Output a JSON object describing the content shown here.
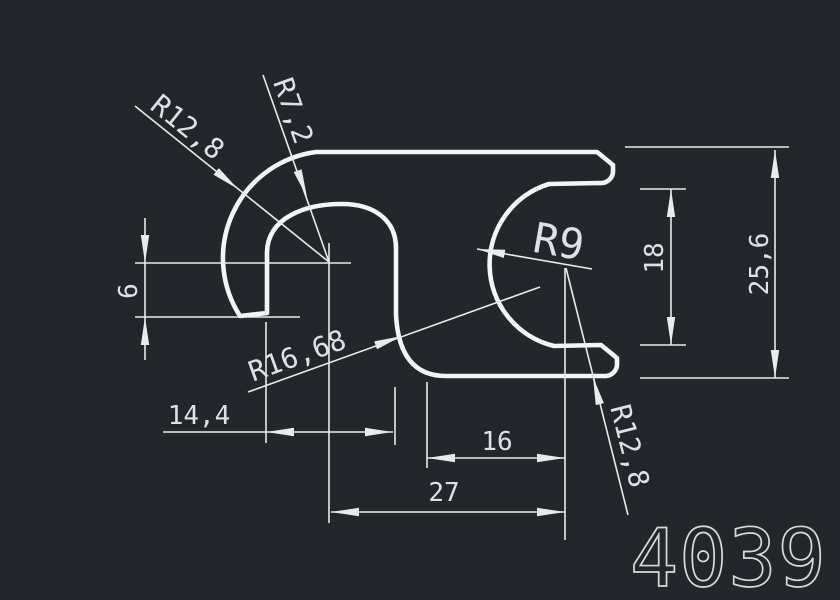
{
  "drawing": {
    "type": "cad-profile-cross-section",
    "part_number": "4039",
    "colors": {
      "background": "#23262b",
      "geometry_line": "#f4f5f6",
      "dimension_line": "#e7ebee",
      "text": "#dde2e6"
    },
    "labels": {
      "radius_hook_outer": "R12,8",
      "radius_arch_inner": "R7,2",
      "radius_c_inner": "R9",
      "radius_s_curve": "R16,68",
      "radius_bottom_arm": "R12,8",
      "width_hook_to_arch": "14,4",
      "width_arm_span": "16",
      "width_overall": "27",
      "height_hook_offset": "6",
      "height_jaw_opening": "18",
      "height_overall": "25,6"
    },
    "dimensions_mm": {
      "radii": [
        12.8,
        7.2,
        9,
        16.68,
        12.8
      ],
      "horizontal": [
        14.4,
        16,
        27
      ],
      "vertical": [
        6,
        18,
        25.6
      ]
    }
  }
}
